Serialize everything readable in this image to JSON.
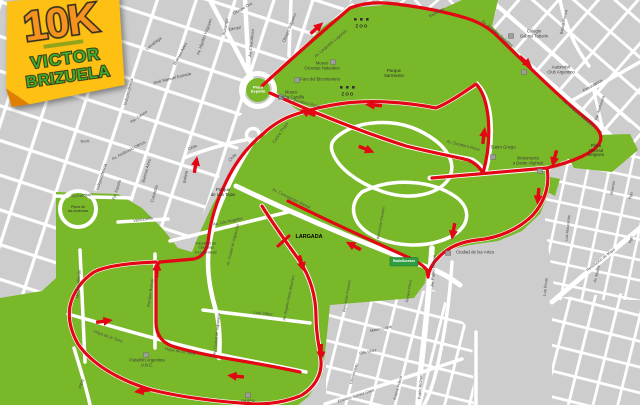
{
  "logo": {
    "distance": "10K",
    "name_line1": "VICTOR",
    "name_line2": "BRIZUELA"
  },
  "map": {
    "colors": {
      "park_green": "#79b829",
      "route_red": "#e30613",
      "block_gray": "#cdcdcd",
      "street_white": "#ffffff",
      "label_gray": "#4a4a4a",
      "sign_green": "#2e9e41",
      "logo_yellow": "#fdc013",
      "logo_orange": "#f6921e",
      "logo_text_green": "#3fae2a"
    },
    "labels": [
      {
        "t": "Obispo Trejo",
        "x": 110,
        "y": 62,
        "r": -75
      },
      {
        "t": "Independencia",
        "x": 129,
        "y": 92,
        "r": -75
      },
      {
        "t": "Pje. Caluso",
        "x": 139,
        "y": 117,
        "r": -35,
        "s": 3.8
      },
      {
        "t": "Larrañaga",
        "x": 154,
        "y": 44,
        "r": -38
      },
      {
        "t": "Buenos Aires",
        "x": 181,
        "y": 54,
        "r": -62
      },
      {
        "t": "José Manuel Estrada",
        "x": 172,
        "y": 79,
        "r": -14
      },
      {
        "t": "Av. Hipólito Yrigoyen",
        "x": 205,
        "y": 37,
        "r": -70
      },
      {
        "t": "Ituzaingó",
        "x": 226,
        "y": 27,
        "r": -78
      },
      {
        "t": "Derqui",
        "x": 235,
        "y": 29,
        "r": -12
      },
      {
        "t": "Obispo Oro",
        "x": 243,
        "y": 9,
        "r": -30
      },
      {
        "t": "Av. Chacabuco",
        "x": 252,
        "y": 43,
        "r": -84
      },
      {
        "t": "Obispo Salguero",
        "x": 290,
        "y": 28,
        "r": -68
      },
      {
        "t": "Av. Leopoldo Lugones",
        "x": 331,
        "y": 44,
        "r": -40
      },
      {
        "t": "Rondeau",
        "x": 437,
        "y": 13,
        "r": -30
      },
      {
        "t": "Perú",
        "x": 85,
        "y": 142,
        "r": -8
      },
      {
        "t": "Av. Ambrosio Olmos",
        "x": 129,
        "y": 151,
        "r": -28
      },
      {
        "t": "Independencia",
        "x": 102,
        "y": 177,
        "r": -72
      },
      {
        "t": "Pje. España",
        "x": 117,
        "y": 190,
        "r": -72,
        "s": 3.8
      },
      {
        "t": "Buenos Aires",
        "x": 147,
        "y": 171,
        "r": -74
      },
      {
        "t": "Colombia",
        "x": 155,
        "y": 194,
        "r": -74
      },
      {
        "t": "Venezuela",
        "x": 143,
        "y": 220,
        "r": -8
      },
      {
        "t": "Richardson",
        "x": 82,
        "y": 196,
        "r": -5
      },
      {
        "t": "Bolivia",
        "x": 186,
        "y": 177,
        "r": -80
      },
      {
        "t": "Chile",
        "x": 193,
        "y": 148,
        "r": -24
      },
      {
        "t": "Chile",
        "x": 233,
        "y": 158,
        "r": -48
      },
      {
        "t": "Carlos Thays",
        "x": 281,
        "y": 133,
        "r": -55
      },
      {
        "t": "Av. Deodoro Roca",
        "x": 303,
        "y": 103,
        "r": 14
      },
      {
        "t": "Av. Deodoro Roca",
        "x": 463,
        "y": 146,
        "r": 14
      },
      {
        "t": "Museo\nCiencias Naturales",
        "x": 322,
        "y": 66,
        "c": "#3c3c3c",
        "n": "museo-ciencias-naturales-label"
      },
      {
        "t": "Faro del Bicentenario",
        "x": 320,
        "y": 80,
        "c": "#3c3c3c",
        "n": "faro-bicentenario-label"
      },
      {
        "t": "Museo\nEmilio Caraffa",
        "x": 291,
        "y": 95,
        "c": "#3c3c3c",
        "n": "museo-caraffa-label"
      },
      {
        "t": "Plaza\nEspaña",
        "x": 258,
        "y": 90,
        "c": "#ffffff",
        "s": 4,
        "w": 700,
        "n": "plaza-espana-label"
      },
      {
        "t": "Parque\nSarmiento",
        "x": 394,
        "y": 74,
        "c": "#2f2f2f",
        "s": 4.4,
        "n": "parque-sarmiento-label"
      },
      {
        "t": "ZOO",
        "x": 362,
        "y": 27,
        "c": "#222222",
        "w": 700,
        "ls": 1.2,
        "s": 4.4,
        "n": "zoo-label"
      },
      {
        "t": "ZOO",
        "x": 348,
        "y": 95,
        "c": "#222222",
        "w": 700,
        "ls": 1.2,
        "s": 4.4,
        "n": "zoo-label"
      },
      {
        "t": "Colegio\nGabriel Taborin",
        "x": 534,
        "y": 34,
        "c": "#3c3c3c",
        "n": "colegio-taborin-label"
      },
      {
        "t": "Automóvil\nClub Argentino",
        "x": 561,
        "y": 70,
        "c": "#3c3c3c",
        "n": "automovil-club-label"
      },
      {
        "t": "Av. Amadeo Sabattini",
        "x": 497,
        "y": 34,
        "r": 40
      },
      {
        "t": "Av. Amadeo Sabattini",
        "x": 578,
        "y": 114,
        "r": 40
      },
      {
        "t": "Bajada Pucará",
        "x": 564,
        "y": 22,
        "r": -78,
        "s": 3.8
      },
      {
        "t": "Ferroviarios",
        "x": 593,
        "y": 86,
        "r": -30
      },
      {
        "t": "Pje. Anchorena",
        "x": 600,
        "y": 108,
        "r": -72,
        "s": 3.8
      },
      {
        "t": "Teatro Griego",
        "x": 503,
        "y": 148,
        "c": "#3c3c3c",
        "n": "teatro-griego-label"
      },
      {
        "t": "Monumento\na Dante Alighieri",
        "x": 528,
        "y": 161,
        "c": "#3c3c3c",
        "n": "monumento-dante-label"
      },
      {
        "t": "Plaza\nGeneral\nBelgrano",
        "x": 596,
        "y": 151,
        "c": "#2f2f2f",
        "s": 4.1,
        "n": "plaza-belgrano-label"
      },
      {
        "t": "Los Araucanos",
        "x": 568,
        "y": 228,
        "r": -84,
        "s": 3.9
      },
      {
        "t": "Miramar",
        "x": 613,
        "y": 188,
        "r": -80,
        "s": 3.8
      },
      {
        "t": "Vigo",
        "x": 631,
        "y": 196,
        "r": -74,
        "s": 3.8
      },
      {
        "t": "Vigo",
        "x": 631,
        "y": 240,
        "r": -74,
        "s": 3.8
      },
      {
        "t": "Revolución de Mayo",
        "x": 601,
        "y": 260,
        "r": -38,
        "s": 3.9
      },
      {
        "t": "Av. Madrid",
        "x": 597,
        "y": 274,
        "r": -76,
        "s": 3.7
      },
      {
        "t": "Los Incas",
        "x": 546,
        "y": 287,
        "r": -84
      },
      {
        "t": "Av. Pablo Richeri",
        "x": 434,
        "y": 271,
        "r": -86
      },
      {
        "t": "Pablo Richeri",
        "x": 421,
        "y": 387,
        "r": -86
      },
      {
        "t": "Ciudad de las Artes",
        "x": 475,
        "y": 253,
        "c": "#3c3c3c",
        "s": 4.4,
        "n": "ciudad-artes-label"
      },
      {
        "t": "RadioSucesos",
        "x": 404,
        "y": 262,
        "c": "#ffffff",
        "s": 3.2,
        "w": 700,
        "n": "radio-sucesos-sign-label"
      },
      {
        "t": "LARGADA",
        "x": 309,
        "y": 237,
        "c": "#000000",
        "s": 5.4,
        "w": 700,
        "n": "start-line-label"
      },
      {
        "t": "Av. Concepción Arenal",
        "x": 291,
        "y": 199,
        "r": 26
      },
      {
        "t": "Parque\nde Las Tejas",
        "x": 223,
        "y": 193,
        "c": "#2f2f2f",
        "s": 4.4,
        "n": "parque-tejas-label"
      },
      {
        "t": "Av. Los Nogales",
        "x": 228,
        "y": 222,
        "r": -12
      },
      {
        "t": "Facultad de\nCiencias\nEconómicas",
        "x": 206,
        "y": 248,
        "c": "#3c3c3c",
        "s": 4,
        "n": "facultad-economicas-label"
      },
      {
        "t": "Av. Ciudad de Valparaíso",
        "x": 233,
        "y": 245,
        "r": -76,
        "s": 3.8
      },
      {
        "t": "Av. Ciudad de Valparaíso",
        "x": 217,
        "y": 334,
        "r": -84,
        "s": 3.8
      },
      {
        "t": "Av. Rogelio Nores Martínez",
        "x": 289,
        "y": 298,
        "r": -78,
        "s": 3.8
      },
      {
        "t": "Luis Vélez",
        "x": 263,
        "y": 314,
        "r": 6
      },
      {
        "t": "Luis Vélez",
        "x": 368,
        "y": 352,
        "r": -12,
        "s": 3.8
      },
      {
        "t": "Mateo Luque",
        "x": 381,
        "y": 329,
        "r": -12,
        "s": 3.8
      },
      {
        "t": "Clemenceau",
        "x": 354,
        "y": 374,
        "r": -74,
        "s": 3.8
      },
      {
        "t": "Emiliano Gómez Clara",
        "x": 356,
        "y": 396,
        "r": -18,
        "s": 3.8
      },
      {
        "t": "Anatole France",
        "x": 398,
        "y": 388,
        "r": -74,
        "s": 3.7
      },
      {
        "t": "Wenceslao Paunero",
        "x": 381,
        "y": 223,
        "r": -80,
        "s": 3.7
      },
      {
        "t": "Wenceslao Paunero",
        "x": 347,
        "y": 296,
        "r": -80,
        "s": 3.7
      },
      {
        "t": "Genaro Pérez",
        "x": 409,
        "y": 291,
        "r": -80,
        "s": 3.7
      },
      {
        "t": "Haya de la Torre",
        "x": 108,
        "y": 337,
        "r": 20
      },
      {
        "t": "Haya de la Torre",
        "x": 180,
        "y": 352,
        "r": 10
      },
      {
        "t": "Medina Allende",
        "x": 79,
        "y": 284,
        "r": -86
      },
      {
        "t": "Enrique Barros",
        "x": 151,
        "y": 293,
        "r": -82
      },
      {
        "t": "Pabellón Argentina\nU.N.C.",
        "x": 147,
        "y": 363,
        "c": "#3c3c3c",
        "s": 4.2,
        "n": "pabellon-argentina-label"
      },
      {
        "t": "Filloy",
        "x": 82,
        "y": 384,
        "r": -78
      },
      {
        "t": "DASPU",
        "x": 248,
        "y": 401,
        "c": "#3c3c3c",
        "s": 4,
        "n": "daspu-label"
      },
      {
        "t": "Plaza de\nlas Américas",
        "x": 78,
        "y": 209,
        "c": "#2f2f2f",
        "s": 3.6,
        "n": "plaza-americas-label"
      }
    ]
  }
}
